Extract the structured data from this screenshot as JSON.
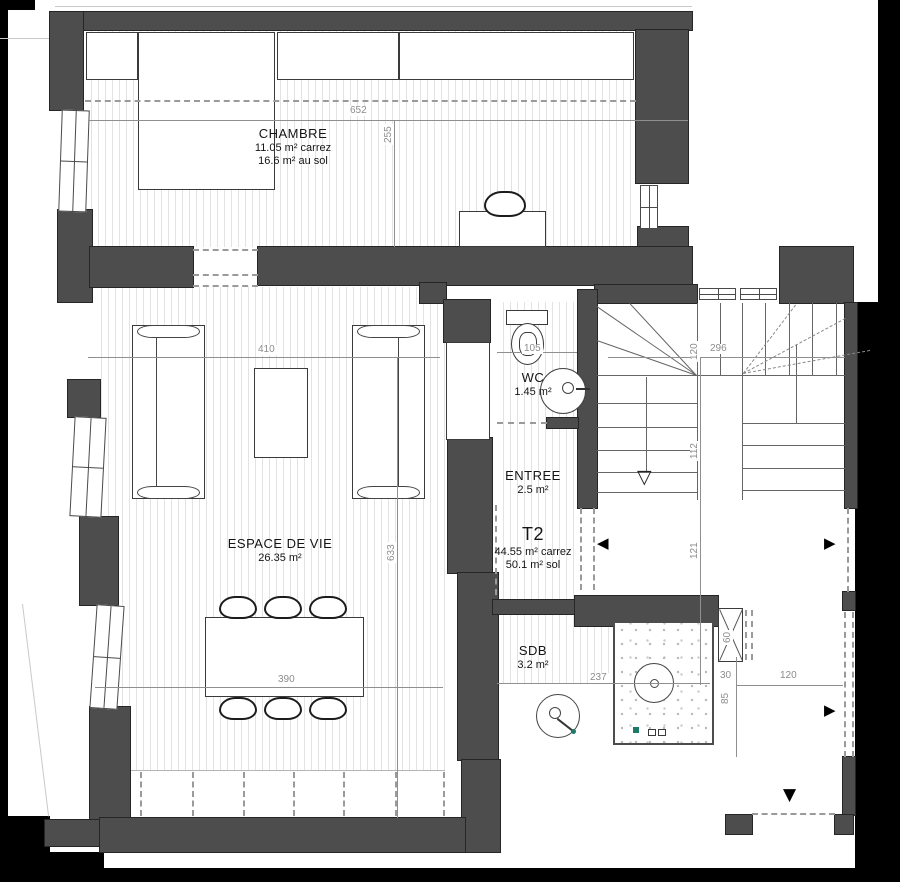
{
  "plan": {
    "rooms": {
      "chambre": {
        "name": "CHAMBRE",
        "area1": "11.05 m² carrez",
        "area2": "16.6 m² au sol"
      },
      "espace_de_vie": {
        "name": "ESPACE DE VIE",
        "area1": "26.35 m²"
      },
      "wc": {
        "name": "WC",
        "area1": "1.45 m²"
      },
      "entree": {
        "name": "ENTREE",
        "area1": "2.5 m²"
      },
      "t2": {
        "name": "T2",
        "area1": "44.55 m² carrez",
        "area2": "50.1 m² sol"
      },
      "sdb": {
        "name": "SDB",
        "area1": "3.2 m²"
      }
    },
    "dims": {
      "bedroom_width": "652",
      "bedroom_depth": "255",
      "living_width": "410",
      "living_depth": "633",
      "table_width": "390",
      "wc_width": "105",
      "stair_width": "296",
      "stair_flight": "120",
      "stair_run": "112",
      "landing_depth": "121",
      "sdb_width": "237",
      "duct_width": "60",
      "gap_width": "30",
      "ledge_depth": "85",
      "corridor_width": "120"
    },
    "symbols": {
      "arrow_left": "◀",
      "arrow_right": "▶",
      "arrow_down": "▼",
      "stair_down": "▽"
    },
    "colors": {
      "wall": "#4d4d4d",
      "paper": "#ffffff",
      "canvas": "#000000",
      "dim_text": "#8c8c8c",
      "accent_teal": "#1d7a68"
    }
  }
}
